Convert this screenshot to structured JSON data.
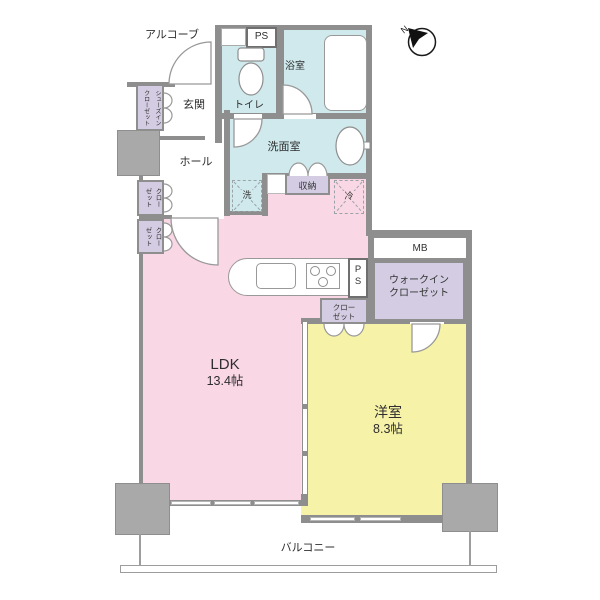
{
  "compass": {
    "label": "N"
  },
  "rooms": {
    "alcove": "アルコーブ",
    "entrance": "玄関",
    "hall": "ホール",
    "toilet": "トイレ",
    "bathroom": "浴室",
    "washroom": "洗面室",
    "ldk_label": "LDK",
    "ldk_size": "13.4帖",
    "western_label": "洋室",
    "western_size": "8.3帖",
    "balcony": "バルコニー"
  },
  "storage": {
    "shoes_closet_col1": "シューズイン",
    "shoes_closet_col2": "クローゼット",
    "closet_col1": "クロー",
    "closet_col2": "ゼット",
    "storage_label": "収納",
    "walkin_line1": "ウォークイン",
    "walkin_line2": "クローゼット",
    "closet_small_line1": "クロー",
    "closet_small_line2": "ゼット"
  },
  "fixtures": {
    "ps_top": "PS",
    "ps_kitchen_p": "P",
    "ps_kitchen_s": "S",
    "mb": "MB",
    "washer": "洗",
    "fridge": "冷"
  },
  "colors": {
    "wall": "#8e8e8e",
    "pillar": "#a9a9a9",
    "ldk_fill": "#f9d7e4",
    "western_fill": "#f6f2a7",
    "wet_area_fill": "#cfe9ec",
    "closet_fill": "#d3cce2"
  }
}
